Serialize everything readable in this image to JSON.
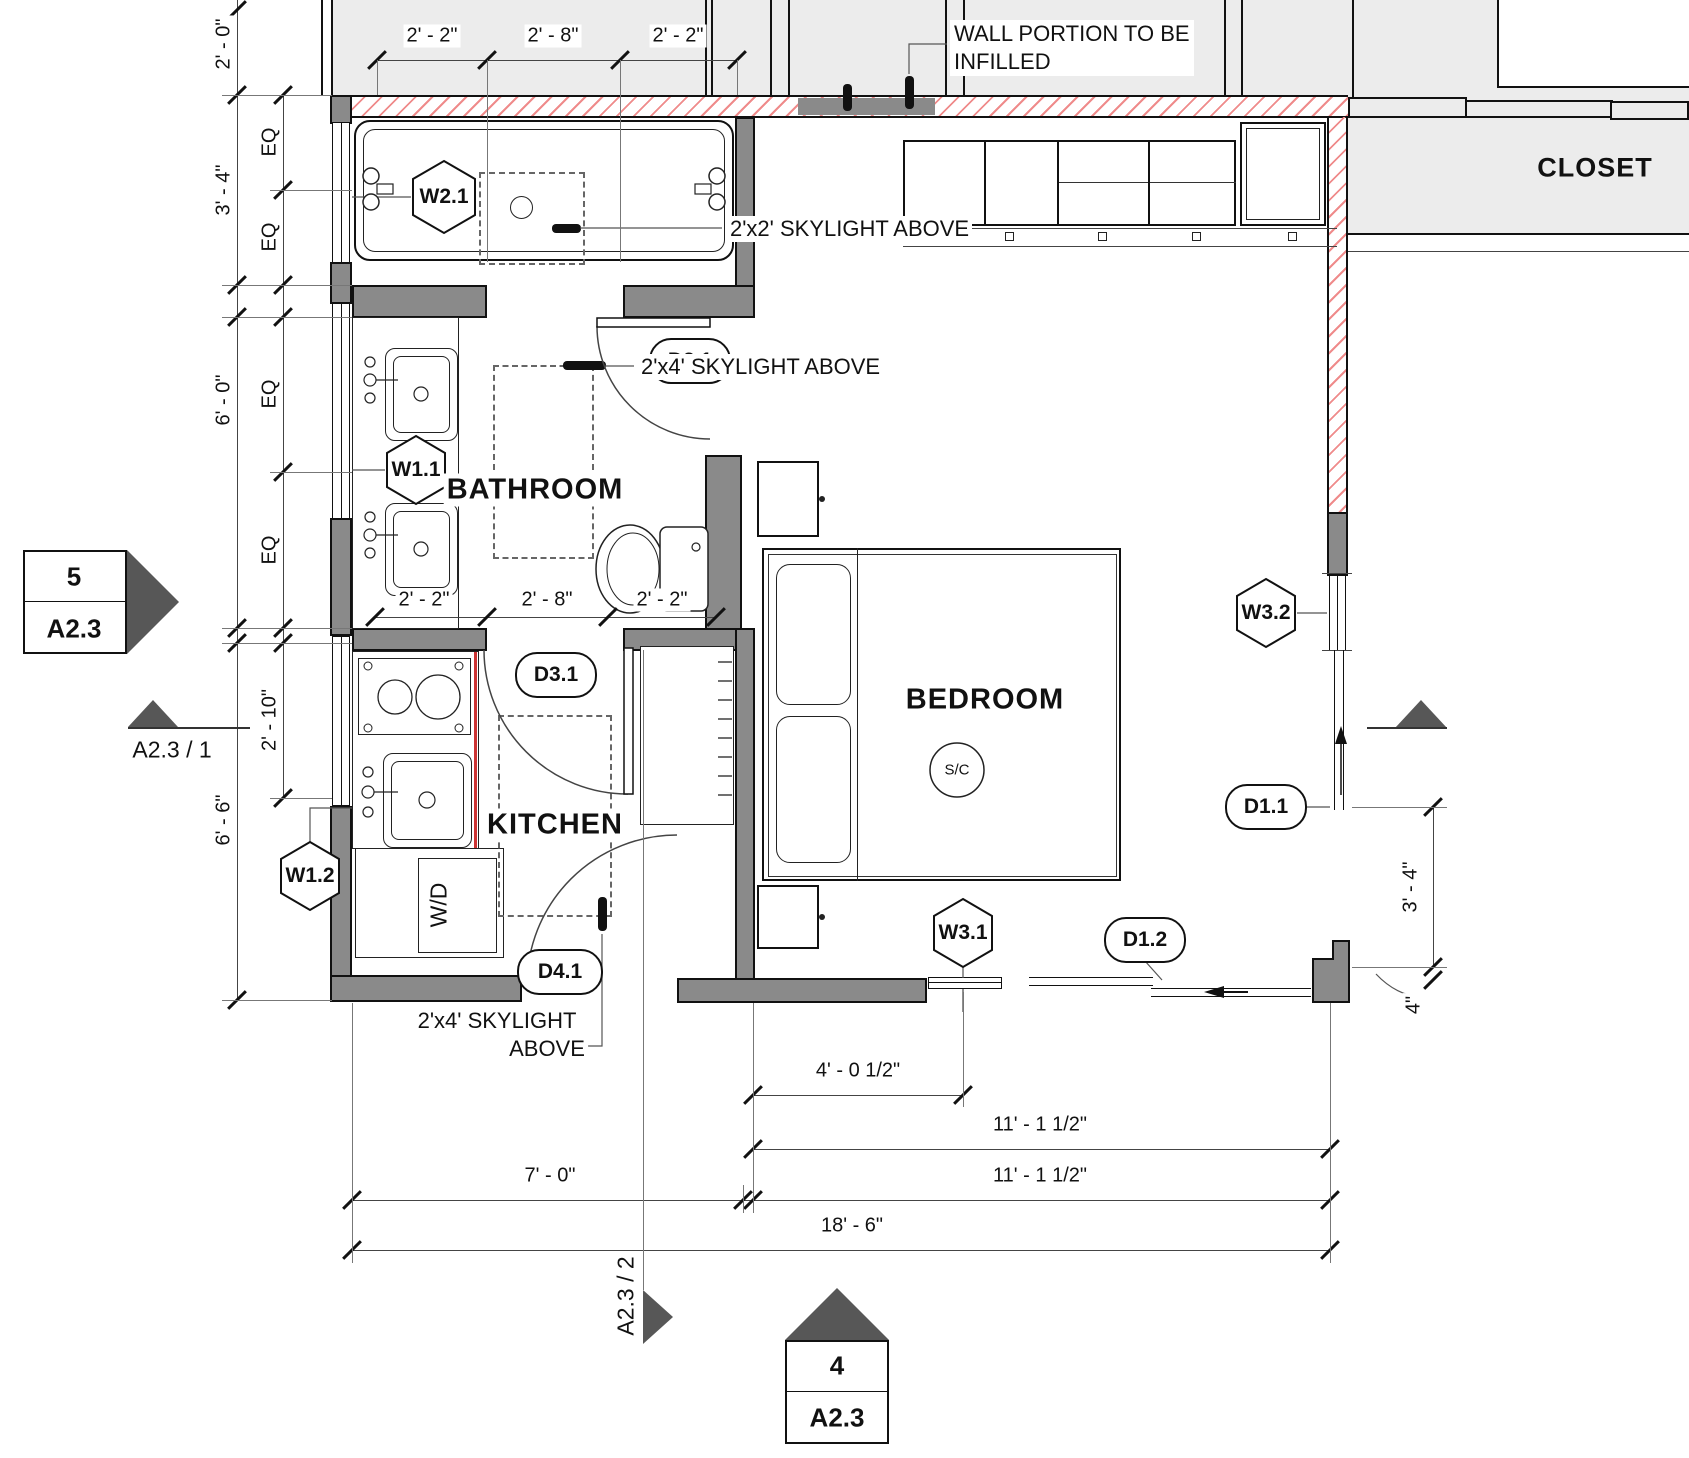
{
  "rooms": {
    "bathroom": "BATHROOM",
    "kitchen": "KITCHEN",
    "bedroom": "BEDROOM",
    "closet": "CLOSET"
  },
  "labels": {
    "wd": "W/D",
    "sc": "S/C"
  },
  "notes": {
    "infill_line1": "WALL PORTION TO BE",
    "infill_line2": "INFILLED",
    "sky2x2": "2'x2' SKYLIGHT ABOVE",
    "sky2x4": "2'x4' SKYLIGHT ABOVE",
    "sky2x4_l1": "2'x4' SKYLIGHT",
    "sky2x4_l2": "ABOVE"
  },
  "tags": {
    "w21": "W2.1",
    "w11": "W1.1",
    "w12": "W1.2",
    "w31": "W3.1",
    "w32": "W3.2",
    "d21": "D2.1",
    "d31": "D3.1",
    "d41": "D4.1",
    "d11": "D1.1",
    "d12": "D1.2"
  },
  "dims": {
    "top": [
      "2' - 2\"",
      "2' - 8\"",
      "2' - 2\""
    ],
    "mid": [
      "2' - 2\"",
      "2' - 8\"",
      "2' - 2\""
    ],
    "left_outer": [
      "2' - 0\"",
      "3' - 4\"",
      "6' - 0\"",
      "6' - 6\""
    ],
    "left_inner": [
      "EQ",
      "EQ",
      "EQ",
      "EQ",
      "2' - 10\""
    ],
    "right": [
      "3' - 4\"",
      "4\""
    ],
    "bottom": [
      "4' - 0 1/2\"",
      "11' - 1 1/2\"",
      "7' - 0\"",
      "11' - 1 1/2\"",
      "18' - 6\""
    ]
  },
  "markers": {
    "m5_num": "5",
    "m5_sheet": "A2.3",
    "m1_label": "A2.3 / 1",
    "m2_label": "A2.3 / 2",
    "m4_num": "4",
    "m4_sheet": "A2.3"
  },
  "colors": {
    "hatch_red": "#ef8b8b",
    "wall_gray": "#8a8a8a",
    "existing_gray": "#ececec",
    "counter_red": "#cc3333"
  }
}
